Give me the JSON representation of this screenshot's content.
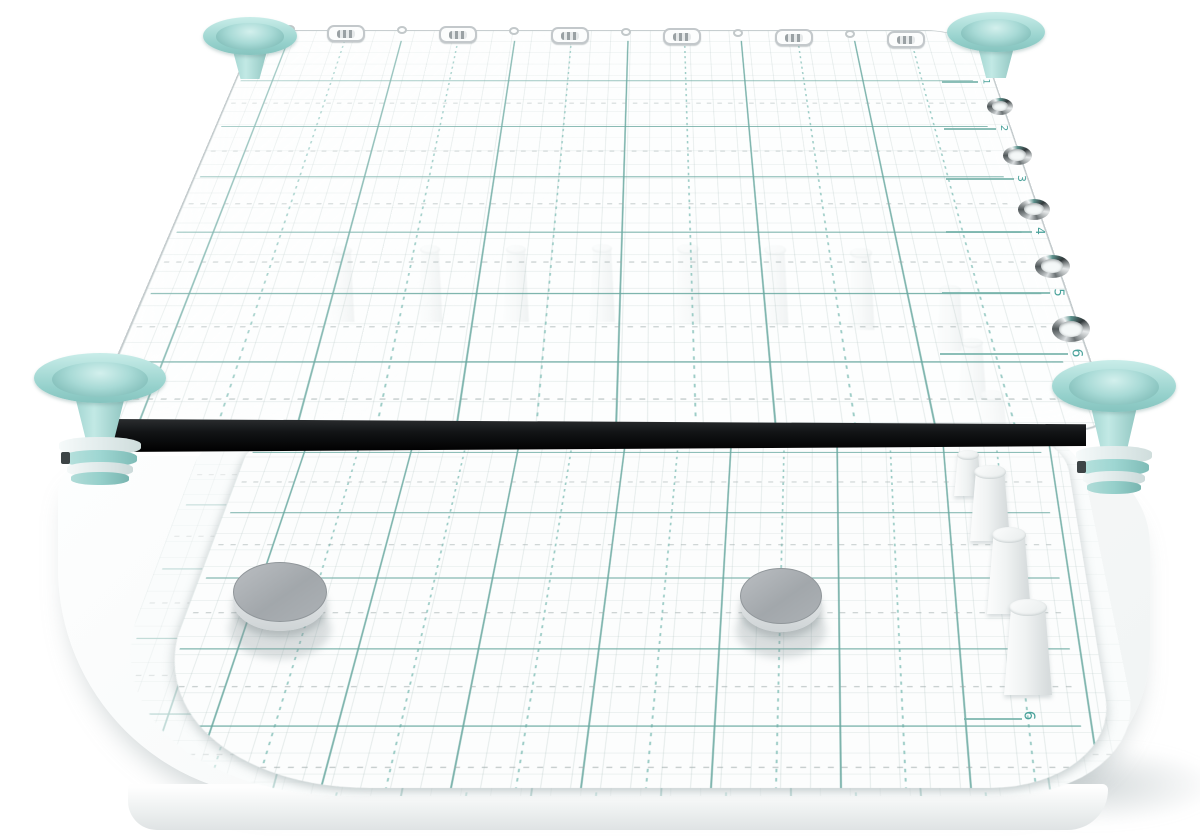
{
  "scene": {
    "type": "product-render",
    "subject": "Transparent acrylic pegboard jig: clear grid-printed top plate with teal corner funnels, chrome grommet holes and ruler numbers, white pegs, above a white base board with grid sheet and two silver magnet discs",
    "width": 1200,
    "height": 836,
    "background": "#ffffff"
  },
  "colors": {
    "background": "#ffffff",
    "teal_light": "#bfe7e4",
    "teal": "#9ed6d2",
    "teal_deep": "#6fb3ae",
    "grid_teal": "rgba(104,168,160,0.85)",
    "grid_teal_soft": "rgba(140,196,189,0.85)",
    "grid_fine": "rgba(170,190,188,0.30)",
    "ruler_text": "#4aa29b",
    "plate_edge": "#9fa9ab",
    "bar_black": "#17191b",
    "chrome_dark": "#4a5052",
    "chrome_light": "#eef0f2",
    "peg_white": "#f3f5f5",
    "disc_top": "#a9aeb2",
    "disc_side": "#e4e7e9",
    "slab_white": "#fbfcfc"
  },
  "top_plate": {
    "ruler_numbers": [
      {
        "label": "1",
        "x": 988,
        "y": 81,
        "size": 9,
        "line": 36
      },
      {
        "label": "2",
        "x": 1006,
        "y": 128,
        "size": 10,
        "line": 52
      },
      {
        "label": "3",
        "x": 1024,
        "y": 178,
        "size": 11,
        "line": 68
      },
      {
        "label": "4",
        "x": 1042,
        "y": 231,
        "size": 12,
        "line": 86
      },
      {
        "label": "5",
        "x": 1060,
        "y": 292,
        "size": 13,
        "line": 108
      },
      {
        "label": "6",
        "x": 1078,
        "y": 353,
        "size": 14,
        "line": 128
      }
    ],
    "grommets": [
      {
        "x": 1000,
        "y": 106,
        "w": 26,
        "h": 17
      },
      {
        "x": 1017,
        "y": 155,
        "w": 29,
        "h": 19
      },
      {
        "x": 1034,
        "y": 209,
        "w": 32,
        "h": 21
      },
      {
        "x": 1052,
        "y": 266,
        "w": 35,
        "h": 23
      },
      {
        "x": 1071,
        "y": 329,
        "w": 38,
        "h": 26
      }
    ],
    "edge_ticks": [
      {
        "x": 290,
        "y": 29
      },
      {
        "x": 402,
        "y": 30
      },
      {
        "x": 514,
        "y": 31
      },
      {
        "x": 626,
        "y": 32
      },
      {
        "x": 738,
        "y": 33
      },
      {
        "x": 850,
        "y": 34
      }
    ],
    "edge_slots": [
      {
        "x": 346,
        "y": 33
      },
      {
        "x": 458,
        "y": 34
      },
      {
        "x": 570,
        "y": 35
      },
      {
        "x": 682,
        "y": 36
      },
      {
        "x": 794,
        "y": 37
      },
      {
        "x": 906,
        "y": 39
      }
    ],
    "grid": {
      "solid_vertical_local_x": [
        48,
        208,
        368,
        528,
        688,
        848
      ],
      "dotted_vertical_local_x": [
        128,
        288,
        448,
        608,
        768,
        928
      ],
      "solid_horizontal_local_y": [
        124,
        228,
        332,
        436,
        540,
        644
      ],
      "dotted_horizontal_local_y": [
        176,
        280,
        384,
        488,
        592,
        696
      ],
      "fine_spacing": 28
    }
  },
  "funnels": [
    {
      "name": "top-left",
      "cx": 250,
      "cy": 36,
      "w": 94,
      "h": 38,
      "cone": 24,
      "stem": false
    },
    {
      "name": "top-right",
      "cx": 996,
      "cy": 32,
      "w": 98,
      "h": 40,
      "cone": 26,
      "stem": false
    },
    {
      "name": "bottom-left",
      "cx": 100,
      "cy": 378,
      "w": 132,
      "h": 50,
      "cone": 40,
      "stem": true
    },
    {
      "name": "bottom-right",
      "cx": 1114,
      "cy": 386,
      "w": 124,
      "h": 52,
      "cone": 40,
      "stem": true
    }
  ],
  "pegs": {
    "through_glass": [
      {
        "x": 342,
        "y": 246,
        "w": 25,
        "h": 76
      },
      {
        "x": 430,
        "y": 245,
        "w": 25,
        "h": 77
      },
      {
        "x": 516,
        "y": 245,
        "w": 26,
        "h": 77
      },
      {
        "x": 602,
        "y": 244,
        "w": 26,
        "h": 78
      },
      {
        "x": 688,
        "y": 244,
        "w": 27,
        "h": 79
      },
      {
        "x": 775,
        "y": 245,
        "w": 27,
        "h": 80
      },
      {
        "x": 861,
        "y": 248,
        "w": 27,
        "h": 82
      },
      {
        "x": 950,
        "y": 285,
        "w": 28,
        "h": 66
      },
      {
        "x": 972,
        "y": 338,
        "w": 29,
        "h": 62
      },
      {
        "x": 992,
        "y": 390,
        "w": 30,
        "h": 40
      }
    ],
    "on_base": [
      {
        "x": 968,
        "y": 450,
        "w": 28,
        "h": 46
      },
      {
        "x": 990,
        "y": 465,
        "w": 40,
        "h": 76
      },
      {
        "x": 1009,
        "y": 527,
        "w": 44,
        "h": 87
      },
      {
        "x": 1028,
        "y": 599,
        "w": 48,
        "h": 96
      }
    ]
  },
  "base": {
    "magnet_discs": [
      {
        "cx": 280,
        "cy": 592,
        "rx": 47,
        "ry": 30,
        "side": 9
      },
      {
        "cx": 781,
        "cy": 596,
        "rx": 41,
        "ry": 28,
        "side": 8
      }
    ],
    "ruler_number": {
      "label": "6",
      "x": 1032,
      "y": 716,
      "size": 15,
      "line": 58
    },
    "sheet_grid": {
      "solid_vertical_local_x": [
        70,
        200,
        330,
        460,
        590,
        720,
        850,
        980
      ],
      "dotted_vertical_local_x": [
        135,
        265,
        395,
        525,
        655,
        785,
        915
      ],
      "solid_horizontal_local_y": [
        50,
        170,
        290,
        410,
        530
      ],
      "dotted_horizontal_local_y": [
        110,
        230,
        350,
        470,
        590
      ],
      "fine_spacing": 30
    }
  }
}
